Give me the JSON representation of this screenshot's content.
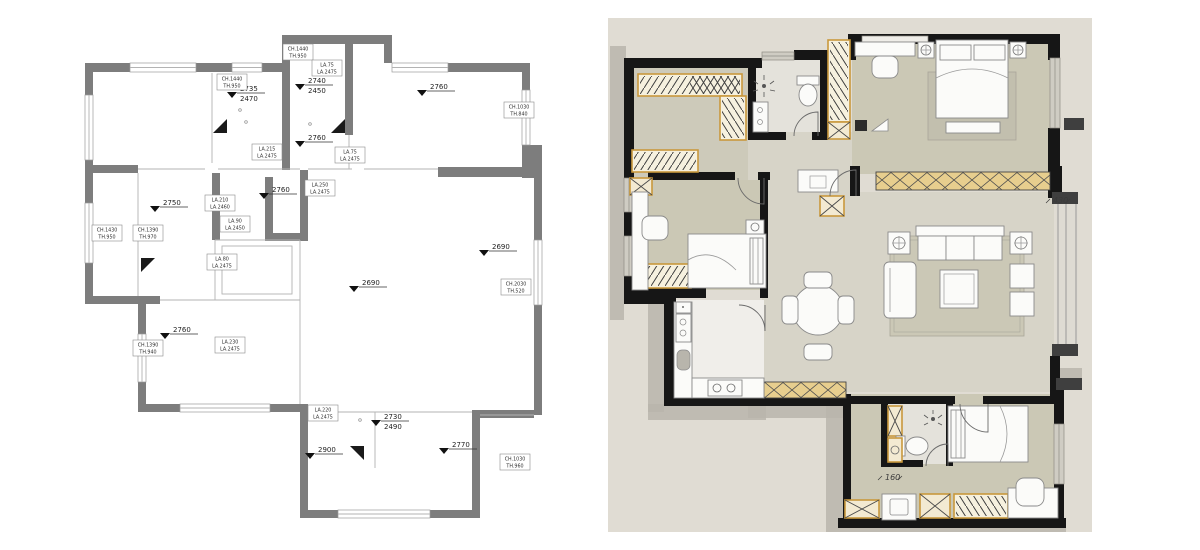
{
  "page": {
    "background": "#ffffff",
    "description": "two apartment floor plans side by side"
  },
  "left_plan": {
    "title": "measured floor plan",
    "colors": {
      "wall": "#7d7d7d",
      "line": "#b3b3b3",
      "text": "#1d1d1d"
    },
    "level_markers": [
      {
        "x": 240,
        "y": 97,
        "lines": [
          "2735",
          "2470"
        ]
      },
      {
        "x": 308,
        "y": 89,
        "lines": [
          "2740",
          "2450"
        ]
      },
      {
        "x": 430,
        "y": 95,
        "lines": [
          "2760"
        ]
      },
      {
        "x": 308,
        "y": 146,
        "lines": [
          "2760"
        ]
      },
      {
        "x": 272,
        "y": 198,
        "lines": [
          "2760"
        ]
      },
      {
        "x": 163,
        "y": 211,
        "lines": [
          "2750"
        ]
      },
      {
        "x": 362,
        "y": 291,
        "lines": [
          "2690"
        ]
      },
      {
        "x": 492,
        "y": 255,
        "lines": [
          "2690"
        ]
      },
      {
        "x": 173,
        "y": 338,
        "lines": [
          "2760"
        ]
      },
      {
        "x": 318,
        "y": 458,
        "lines": [
          "2900"
        ]
      },
      {
        "x": 384,
        "y": 425,
        "lines": [
          "2730",
          "2490"
        ]
      },
      {
        "x": 452,
        "y": 453,
        "lines": [
          "2770"
        ]
      }
    ],
    "ref_labels": [
      {
        "x": 298,
        "y": 52,
        "lines": [
          "CH.1440",
          "TH.950"
        ]
      },
      {
        "x": 232,
        "y": 82,
        "lines": [
          "CH.1440",
          "TH.950"
        ]
      },
      {
        "x": 327,
        "y": 68,
        "lines": [
          "LA.75",
          "LA.2475"
        ]
      },
      {
        "x": 267,
        "y": 152,
        "lines": [
          "LA.215",
          "LA.2475"
        ]
      },
      {
        "x": 350,
        "y": 155,
        "lines": [
          "LA.75",
          "LA.2475"
        ]
      },
      {
        "x": 320,
        "y": 188,
        "lines": [
          "LA.250",
          "LA.2475"
        ]
      },
      {
        "x": 220,
        "y": 203,
        "lines": [
          "LA.210",
          "LA.2460"
        ]
      },
      {
        "x": 235,
        "y": 224,
        "lines": [
          "LA.90",
          "LA.2450"
        ]
      },
      {
        "x": 222,
        "y": 262,
        "lines": [
          "LA.80",
          "LA.2475"
        ]
      },
      {
        "x": 107,
        "y": 233,
        "lines": [
          "CH.1430",
          "TH.950"
        ]
      },
      {
        "x": 148,
        "y": 233,
        "lines": [
          "CH.1390",
          "TH.970"
        ]
      },
      {
        "x": 148,
        "y": 348,
        "lines": [
          "CH.1390",
          "TH.940"
        ]
      },
      {
        "x": 230,
        "y": 345,
        "lines": [
          "LA.230",
          "LA.2475"
        ]
      },
      {
        "x": 323,
        "y": 413,
        "lines": [
          "LA.220",
          "LA.2475"
        ]
      },
      {
        "x": 519,
        "y": 110,
        "lines": [
          "CH.1030",
          "TH.840"
        ]
      },
      {
        "x": 516,
        "y": 287,
        "lines": [
          "CH.2030",
          "TH.520"
        ]
      },
      {
        "x": 515,
        "y": 462,
        "lines": [
          "CH.1030",
          "TH.960"
        ]
      }
    ]
  },
  "right_plan": {
    "title": "furnished floor plan",
    "colors": {
      "canvas": "#e0dcd3",
      "wall": "#161616",
      "bedroom_floor": "#cbc8b5",
      "hall_floor": "#d7d4c8",
      "bath_floor": "#e4e2db",
      "kitchen_floor": "#f0eeea",
      "rug": "#c4c1af",
      "wardrobe_accent": "#c9983d",
      "window_seat": "#e7ce8e",
      "shadow": "#b9b5ab"
    },
    "dim_labels": [
      {
        "id": "living-jog-dim",
        "text": "430"
      },
      {
        "id": "bedroom3-niche-dim",
        "text": "160"
      }
    ]
  }
}
